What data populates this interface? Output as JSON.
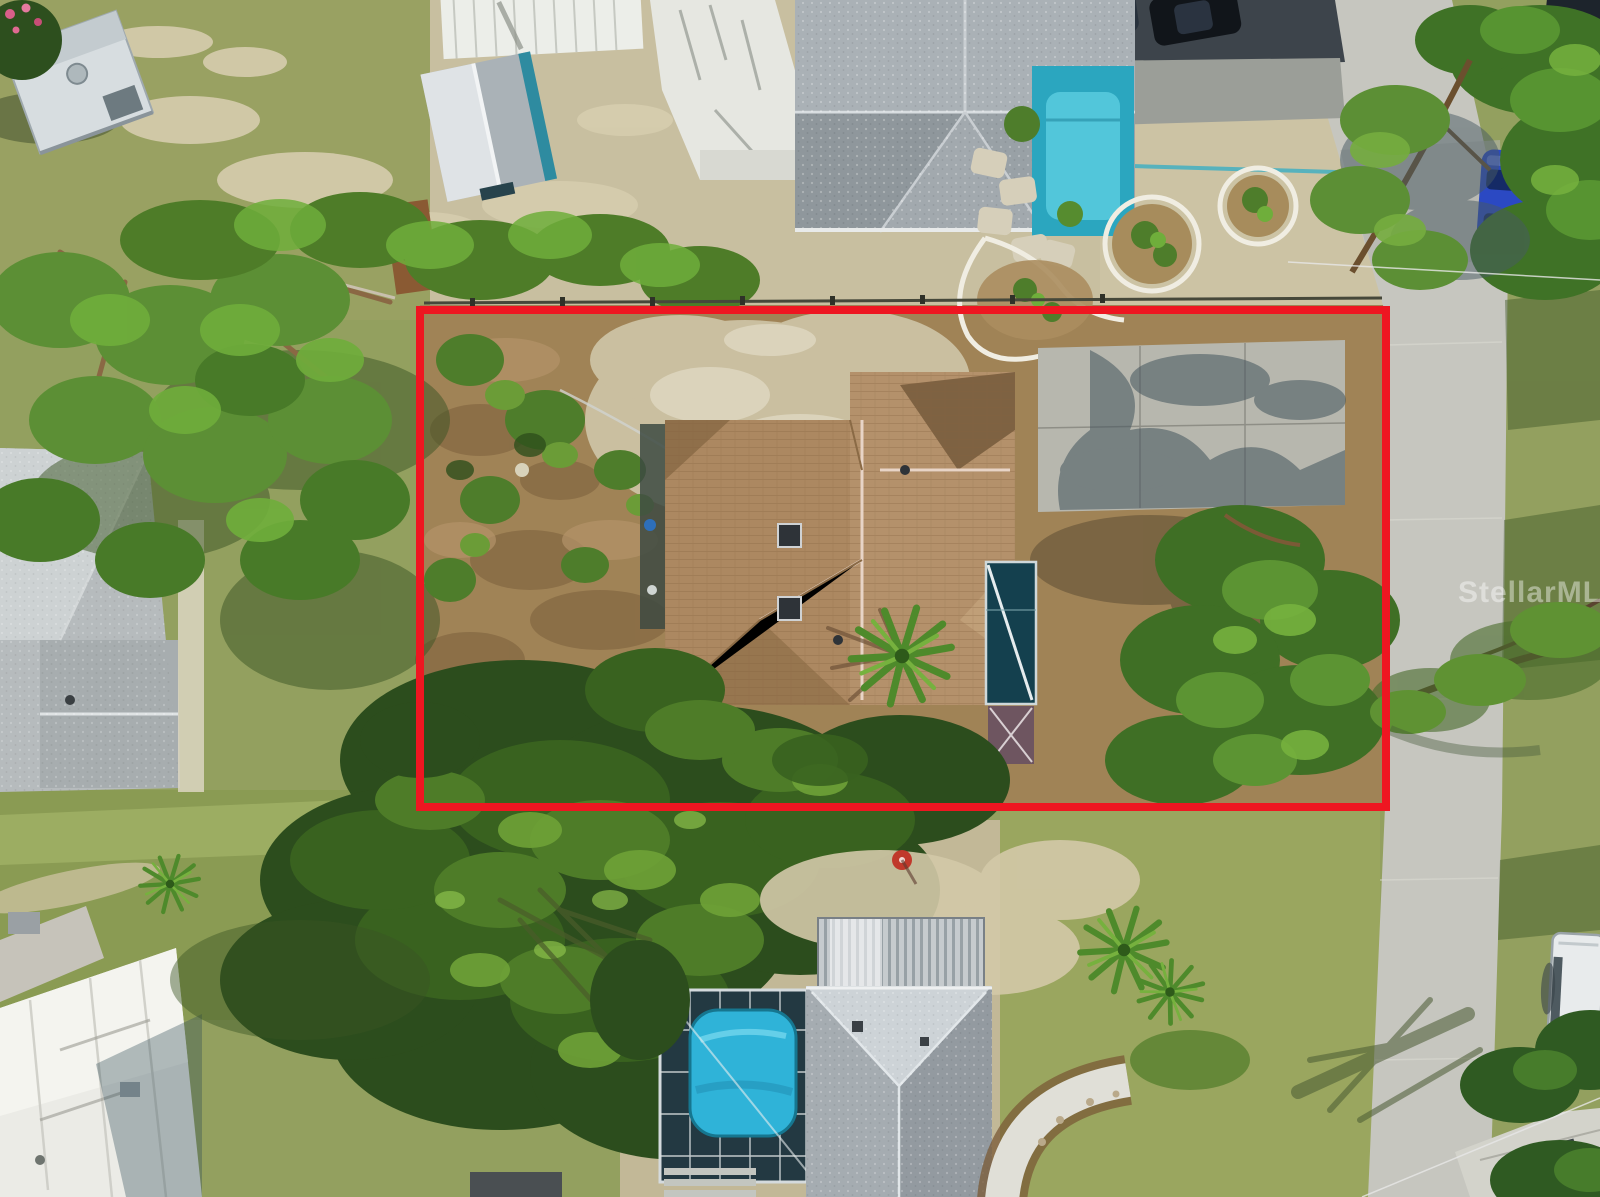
{
  "image": {
    "title": "Aerial drone photo of residential lot with property boundary overlay",
    "width_px": 1600,
    "height_px": 1197
  },
  "watermark": {
    "text": "StellarMLS",
    "color": "#ffffff",
    "opacity": 0.42
  },
  "property_outline": {
    "color": "#ee1621",
    "stroke_px": 8,
    "x": 420,
    "y": 310,
    "width": 966,
    "height": 497
  },
  "colors": {
    "grass_olive": "#93a05f",
    "sand": "#cbc2a3",
    "dirt_brown": "#9c7c50",
    "road_gray": "#c6c6bf",
    "asphalt_dark": "#3d444b",
    "canopy_dark_green": "#2c4d1d",
    "canopy_mid_green": "#4e7c28",
    "canopy_bright_green": "#6fae3b",
    "center_roof_tan": "#b4916b",
    "top_house_gray_roof": "#a2a9ae",
    "bottom_house_gray_roof": "#b3b9be",
    "pool_blue": "#2fb3d8",
    "teal_patio": "#2ba6bf",
    "pool_cage_dark": "#233942",
    "white_building": "#ebebe6",
    "trailer_white": "#d7dde0",
    "blue_car": "#2b49c3",
    "rv_white": "#e8ebec",
    "red_outline": "#ee1621"
  }
}
